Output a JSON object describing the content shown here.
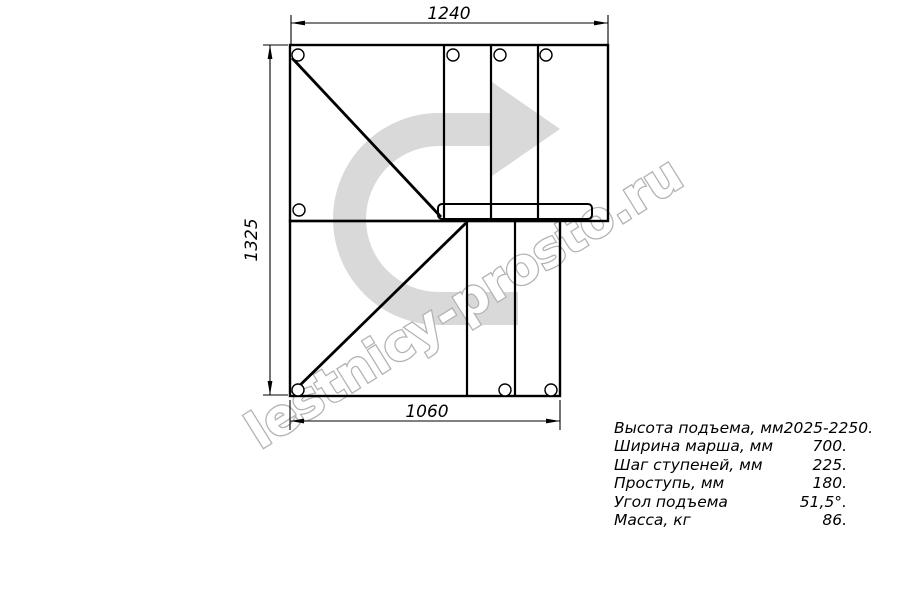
{
  "watermark": {
    "text": "lestnicy-prosto.ru",
    "arrow_color": "#d9d9d9",
    "outline_color": "#b3b3b3"
  },
  "dimensions": {
    "top_width": "1240",
    "left_height": "1325",
    "bottom_width": "1060"
  },
  "specs": {
    "rows": [
      {
        "label": "Высота подъема, мм",
        "value": "2025-2250."
      },
      {
        "label": "Ширина марша, мм",
        "value": "700."
      },
      {
        "label": "Шаг ступеней, мм",
        "value": "225."
      },
      {
        "label": "Проступь, мм",
        "value": "180."
      },
      {
        "label": "Угол подъема",
        "value": "51,5°."
      },
      {
        "label": "Масса, кг",
        "value": "86."
      }
    ]
  }
}
